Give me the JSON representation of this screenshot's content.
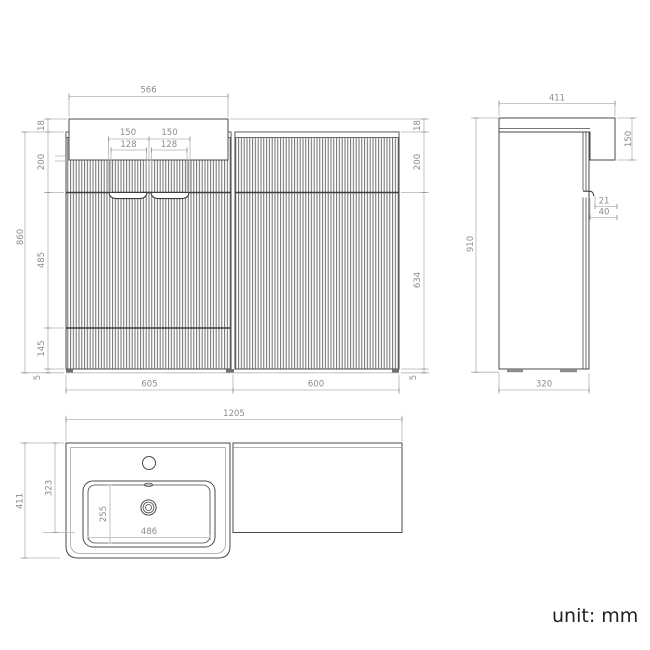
{
  "drawing": {
    "type": "bathroom vanity technical drawing, three orthographic views"
  },
  "front_view": {
    "top_width": "566",
    "handle_spans": [
      "150",
      "150"
    ],
    "handle_widths": [
      "128",
      "128"
    ],
    "left_dims": [
      "18",
      "200",
      "485",
      "145",
      "5"
    ],
    "total_height": "860",
    "right_dims": [
      "18",
      "200",
      "634",
      "5"
    ],
    "bottom_widths": [
      "605",
      "600"
    ]
  },
  "side_view": {
    "top_depth": "411",
    "front_drop": "150",
    "handle_inset": "21",
    "handle_recess": "40",
    "total_height": "910",
    "base_depth": "320"
  },
  "top_view": {
    "total_width": "1205",
    "overall_depth": "411",
    "counter_depth": "323",
    "basin_depth": "255",
    "basin_width": "486"
  },
  "footer": {
    "unit_label": "unit: mm"
  },
  "colors": {
    "drawing_line": "#4a4a4a",
    "dimension_line": "#b4b4b4",
    "dimension_text": "#8c8c8c",
    "note_text": "#212121",
    "background": "#ffffff"
  }
}
